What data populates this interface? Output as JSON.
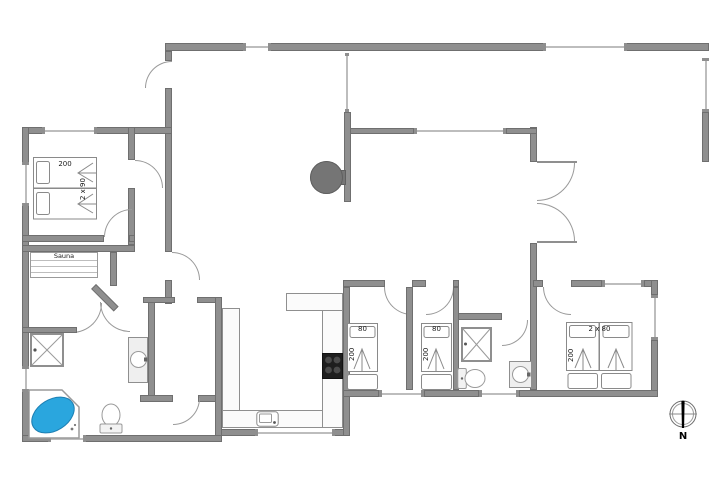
{
  "colors": {
    "wall": "#8f8f8f",
    "wall_edge": "#6f6f6f",
    "window_line": "#bdbdbd",
    "line": "#9a9a9a",
    "counter": "#fbfbfb",
    "tub_water": "#2aa6de",
    "tub_edge": "#1d7fb3",
    "stove": "#1e1e1e",
    "burner": "#4a4a4a",
    "fireplace": "#757575",
    "text": "#1a1a1a"
  },
  "labels": {
    "sauna": "Sauna",
    "bedroom_nw_length": "200",
    "bedroom_nw_width": "2 x 90",
    "bed_s1_width": "80",
    "bed_s1_length": "200",
    "bed_s2_width": "80",
    "bed_s2_length": "200",
    "bedroom_se_width": "2 x 80",
    "bedroom_se_length": "200",
    "compass_north": "N"
  },
  "fixtures": [
    "double-bed-2x90",
    "sauna-bench",
    "shower-cabin-west",
    "corner-bathtub",
    "toilet-west",
    "washbasin-west",
    "kitchen-counter",
    "kitchen-stove",
    "kitchen-sink",
    "wood-stove",
    "single-bed-80-a",
    "single-bed-80-b",
    "shower-cabin-east",
    "toilet-east",
    "washbasin-east",
    "double-bed-2x80",
    "compass-rose"
  ]
}
